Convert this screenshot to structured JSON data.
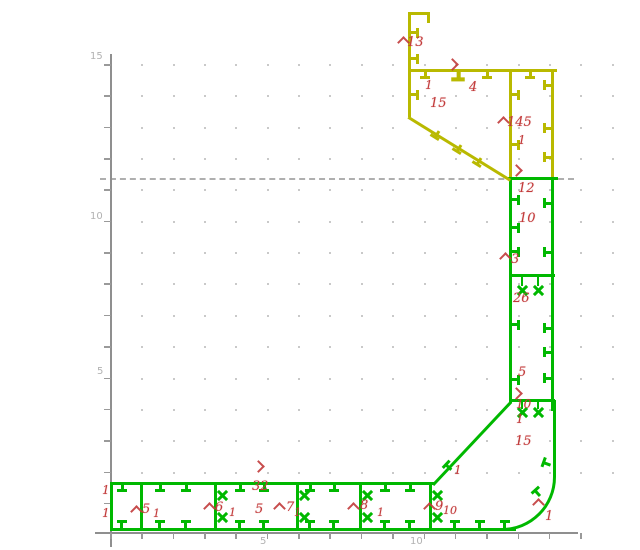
{
  "drawing": {
    "background": "#ffffff",
    "colors": {
      "green": "#00b800",
      "yellow": "#b9b900",
      "red": "#c23a3a",
      "axis": "#8f8f8f",
      "grid_dot": "#c9c9c9",
      "dash": "#9c9c9c",
      "label_gray": "#b2b2b2"
    },
    "axis": {
      "y_line": [
        110,
        54,
        2,
        493
      ],
      "x_line": [
        95,
        532,
        483,
        2
      ],
      "y_ticks": {
        "x": 104,
        "w": 7,
        "y0": 64,
        "step": 31.35,
        "count": 15
      },
      "x_ticks": {
        "y": 533,
        "h": 6,
        "x0": 110,
        "step": 31.35,
        "count": 16
      },
      "y_labels": [
        {
          "t": "15",
          "x": 90,
          "y": 51
        },
        {
          "t": "10",
          "x": 90,
          "y": 211
        },
        {
          "t": "5",
          "x": 97,
          "y": 366
        }
      ],
      "x_labels": [
        {
          "t": "5",
          "x": 260,
          "y": 536
        },
        {
          "t": "10",
          "x": 410,
          "y": 536
        }
      ]
    },
    "grid": {
      "x0": 141.35,
      "y0": 64,
      "step": 31.35,
      "cols": 16,
      "rows": 14
    },
    "dashed_line": {
      "x": 100,
      "y": 178,
      "w": 474
    },
    "rects": {
      "yellow": [
        [
          408,
          12,
          22,
          3
        ],
        [
          427,
          12,
          3,
          11
        ],
        [
          408,
          12,
          3,
          105
        ],
        [
          408,
          69,
          149,
          3
        ],
        [
          509,
          69,
          3,
          110
        ],
        [
          551,
          69,
          3,
          110
        ]
      ],
      "green": [
        [
          508,
          177,
          50,
          3
        ],
        [
          509,
          179,
          3,
          224
        ],
        [
          551,
          179,
          3,
          232
        ],
        [
          509,
          274,
          46,
          3
        ],
        [
          509,
          399,
          46,
          3
        ],
        [
          110,
          482,
          325,
          3
        ],
        [
          110,
          482,
          3,
          49
        ],
        [
          140,
          482,
          3,
          49
        ],
        [
          214,
          482,
          3,
          49
        ],
        [
          296,
          482,
          3,
          49
        ],
        [
          359,
          482,
          3,
          49
        ],
        [
          429,
          482,
          3,
          49
        ],
        [
          110,
          528,
          406,
          3
        ],
        [
          521,
          277,
          2,
          9
        ],
        [
          537,
          277,
          2,
          9
        ],
        [
          521,
          402,
          2,
          7
        ],
        [
          537,
          402,
          2,
          7
        ]
      ]
    },
    "diagonals": [
      {
        "x": 409,
        "y": 116,
        "len": 120,
        "ang": 31.7,
        "c": "yellow"
      },
      {
        "x": 432,
        "y": 484,
        "len": 114,
        "ang": -46.8,
        "c": "green"
      }
    ],
    "curve": {
      "x": 429,
      "y": 400,
      "w": 124,
      "h": 128,
      "r": 54,
      "c": "green"
    },
    "ticks": [
      {
        "x": 415,
        "y": 33,
        "d": "right",
        "c": "yellow"
      },
      {
        "x": 415,
        "y": 59,
        "d": "right",
        "c": "yellow"
      },
      {
        "x": 415,
        "y": 95,
        "d": "right",
        "c": "yellow"
      },
      {
        "x": 516,
        "y": 95,
        "d": "right",
        "c": "yellow"
      },
      {
        "x": 516,
        "y": 145,
        "d": "right",
        "c": "yellow"
      },
      {
        "x": 547,
        "y": 85,
        "d": "left",
        "c": "yellow"
      },
      {
        "x": 547,
        "y": 128,
        "d": "left",
        "c": "yellow"
      },
      {
        "x": 547,
        "y": 157,
        "d": "left",
        "c": "yellow"
      },
      {
        "x": 425,
        "y": 75,
        "d": "down",
        "c": "yellow"
      },
      {
        "x": 458,
        "y": 76,
        "d": "down",
        "c": "yellow",
        "s": 1.35
      },
      {
        "x": 487,
        "y": 75,
        "d": "down",
        "c": "yellow"
      },
      {
        "x": 530,
        "y": 75,
        "d": "down",
        "c": "yellow"
      },
      {
        "x": 436,
        "y": 135,
        "d": "down",
        "a": 32,
        "c": "yellow"
      },
      {
        "x": 458,
        "y": 149,
        "d": "down",
        "a": 32,
        "c": "yellow"
      },
      {
        "x": 478,
        "y": 162,
        "d": "down",
        "a": 32,
        "c": "yellow"
      },
      {
        "x": 122,
        "y": 488,
        "d": "down",
        "c": "green"
      },
      {
        "x": 160,
        "y": 488,
        "d": "down",
        "c": "green"
      },
      {
        "x": 186,
        "y": 488,
        "d": "down",
        "c": "green"
      },
      {
        "x": 240,
        "y": 488,
        "d": "down",
        "c": "green"
      },
      {
        "x": 264,
        "y": 488,
        "d": "down",
        "c": "green"
      },
      {
        "x": 310,
        "y": 488,
        "d": "down",
        "c": "green"
      },
      {
        "x": 334,
        "y": 488,
        "d": "down",
        "c": "green"
      },
      {
        "x": 385,
        "y": 488,
        "d": "down",
        "c": "green"
      },
      {
        "x": 410,
        "y": 488,
        "d": "down",
        "c": "green"
      },
      {
        "x": 122,
        "y": 524,
        "d": "up",
        "c": "green"
      },
      {
        "x": 160,
        "y": 524,
        "d": "up",
        "c": "green"
      },
      {
        "x": 186,
        "y": 524,
        "d": "up",
        "c": "green"
      },
      {
        "x": 240,
        "y": 524,
        "d": "up",
        "c": "green"
      },
      {
        "x": 264,
        "y": 524,
        "d": "up",
        "c": "green"
      },
      {
        "x": 310,
        "y": 524,
        "d": "up",
        "c": "green"
      },
      {
        "x": 334,
        "y": 524,
        "d": "up",
        "c": "green"
      },
      {
        "x": 385,
        "y": 524,
        "d": "up",
        "c": "green"
      },
      {
        "x": 410,
        "y": 524,
        "d": "up",
        "c": "green"
      },
      {
        "x": 455,
        "y": 524,
        "d": "up",
        "c": "green"
      },
      {
        "x": 480,
        "y": 524,
        "d": "up",
        "c": "green"
      },
      {
        "x": 505,
        "y": 524,
        "d": "up",
        "c": "green"
      },
      {
        "x": 516,
        "y": 200,
        "d": "right",
        "c": "green"
      },
      {
        "x": 516,
        "y": 228,
        "d": "right",
        "c": "green"
      },
      {
        "x": 516,
        "y": 252,
        "d": "right",
        "c": "green"
      },
      {
        "x": 516,
        "y": 325,
        "d": "right",
        "c": "green"
      },
      {
        "x": 516,
        "y": 380,
        "d": "right",
        "c": "green"
      },
      {
        "x": 547,
        "y": 203,
        "d": "left",
        "c": "green"
      },
      {
        "x": 547,
        "y": 252,
        "d": "left",
        "c": "green"
      },
      {
        "x": 547,
        "y": 328,
        "d": "left",
        "c": "green"
      },
      {
        "x": 547,
        "y": 352,
        "d": "left",
        "c": "green"
      },
      {
        "x": 547,
        "y": 378,
        "d": "left",
        "c": "green"
      },
      {
        "x": 546,
        "y": 463,
        "d": "left",
        "a": 20,
        "c": "green"
      },
      {
        "x": 537,
        "y": 492,
        "d": "left",
        "a": 48,
        "c": "green"
      },
      {
        "x": 448,
        "y": 466,
        "d": "up",
        "a": -47,
        "c": "green"
      }
    ],
    "xmarks": [
      [
        222,
        495
      ],
      [
        222,
        517
      ],
      [
        304,
        495
      ],
      [
        304,
        517
      ],
      [
        367,
        495
      ],
      [
        367,
        517
      ],
      [
        437,
        495
      ],
      [
        437,
        517
      ],
      [
        522,
        290
      ],
      [
        538,
        290
      ],
      [
        522,
        412
      ],
      [
        538,
        412
      ]
    ],
    "arrows": [
      {
        "d": "up",
        "x": 399,
        "y": 38
      },
      {
        "d": "up",
        "x": 499,
        "y": 118
      },
      {
        "d": "up",
        "x": 501,
        "y": 254
      },
      {
        "d": "up",
        "x": 132,
        "y": 507
      },
      {
        "d": "up",
        "x": 205,
        "y": 504
      },
      {
        "d": "up",
        "x": 275,
        "y": 504
      },
      {
        "d": "up",
        "x": 349,
        "y": 504
      },
      {
        "d": "up",
        "x": 425,
        "y": 504
      },
      {
        "d": "up",
        "x": 534,
        "y": 500
      },
      {
        "d": "right",
        "x": 448,
        "y": 60
      },
      {
        "d": "right",
        "x": 512,
        "y": 166
      },
      {
        "d": "right",
        "x": 512,
        "y": 389
      },
      {
        "d": "right",
        "x": 254,
        "y": 462
      }
    ],
    "labels": [
      {
        "t": "13",
        "x": 407,
        "y": 36
      },
      {
        "t": "1",
        "x": 425,
        "y": 79,
        "fs": 12
      },
      {
        "t": "4",
        "x": 469,
        "y": 81
      },
      {
        "t": "15",
        "x": 430,
        "y": 97
      },
      {
        "t": "145",
        "x": 507,
        "y": 116
      },
      {
        "t": "1",
        "x": 518,
        "y": 134,
        "fs": 12
      },
      {
        "t": "12",
        "x": 518,
        "y": 182
      },
      {
        "t": "10",
        "x": 519,
        "y": 212
      },
      {
        "t": "3",
        "x": 511,
        "y": 253
      },
      {
        "t": "26",
        "x": 513,
        "y": 292
      },
      {
        "t": "5",
        "x": 518,
        "y": 366
      },
      {
        "t": "10",
        "x": 516,
        "y": 398,
        "fs": 12
      },
      {
        "t": "1",
        "x": 516,
        "y": 413,
        "fs": 12
      },
      {
        "t": "15",
        "x": 515,
        "y": 435
      },
      {
        "t": "1",
        "x": 545,
        "y": 510
      },
      {
        "t": "1",
        "x": 102,
        "y": 484,
        "fs": 12
      },
      {
        "t": "1",
        "x": 102,
        "y": 507,
        "fs": 12
      },
      {
        "t": "5",
        "x": 142,
        "y": 503
      },
      {
        "t": "1",
        "x": 153,
        "y": 508,
        "fs": 11
      },
      {
        "t": "6",
        "x": 215,
        "y": 501
      },
      {
        "t": "1",
        "x": 229,
        "y": 507,
        "fs": 11
      },
      {
        "t": "32",
        "x": 252,
        "y": 480
      },
      {
        "t": "5",
        "x": 255,
        "y": 503
      },
      {
        "t": "7",
        "x": 286,
        "y": 501
      },
      {
        "t": "1",
        "x": 294,
        "y": 507,
        "fs": 11
      },
      {
        "t": "8",
        "x": 360,
        "y": 499
      },
      {
        "t": "1",
        "x": 377,
        "y": 507,
        "fs": 11
      },
      {
        "t": "9",
        "x": 435,
        "y": 500
      },
      {
        "t": "10",
        "x": 443,
        "y": 505,
        "fs": 11
      },
      {
        "t": "1",
        "x": 454,
        "y": 464,
        "fs": 12
      }
    ]
  }
}
